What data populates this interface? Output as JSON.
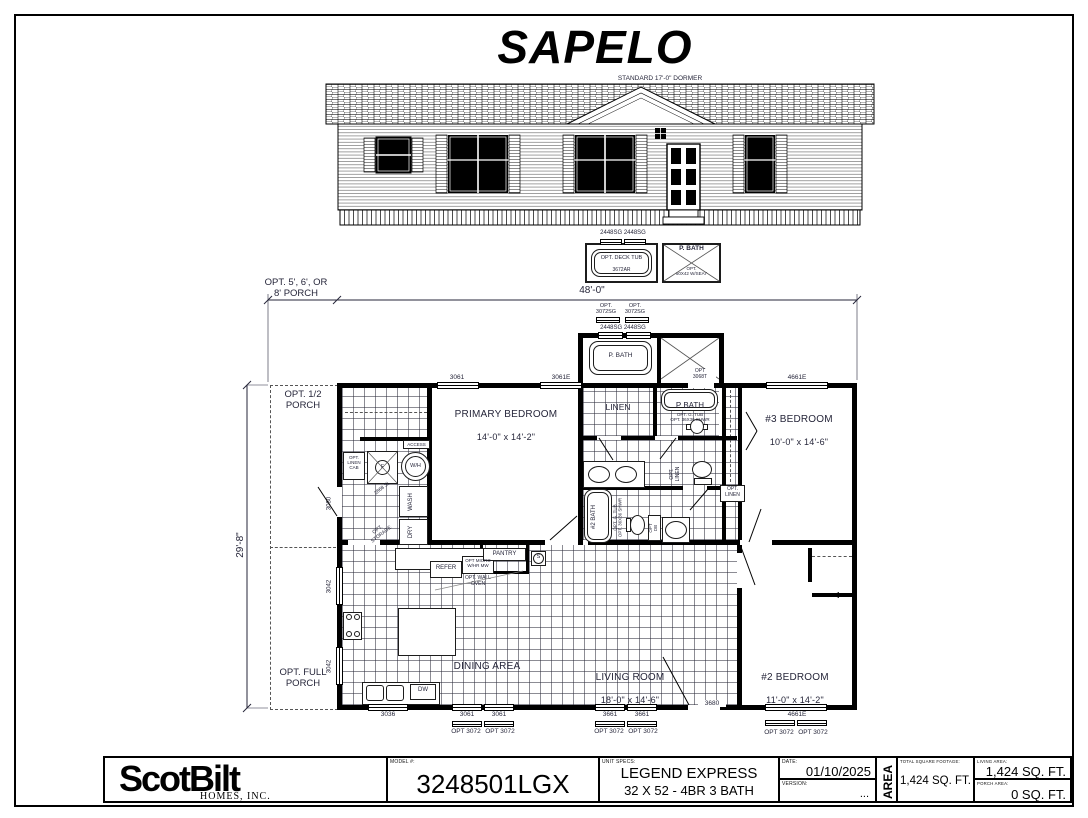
{
  "title": "SAPELO",
  "elevation": {
    "dormer_note": "STANDARD 17'-0\" DORMER"
  },
  "detail": {
    "win_pair": "2448SG 2448SG",
    "deck_tub": "OPT. DECK TUB",
    "deck_tub_size": "3672AR",
    "p_bath": "P. BATH",
    "p_bath_seat": "OPT.\n60X42 W/SEAT"
  },
  "dims": {
    "width": "48'-0\"",
    "porch_opt": "OPT. 5', 6', OR\n8' PORCH",
    "depth": "29'-8\""
  },
  "bump": {
    "opt3072": "OPT.\n3072SG",
    "win_pair": "2448SG 2448SG",
    "p_bath": "P. BATH",
    "door": "OPT\n3068T"
  },
  "plan": {
    "porch_half": "OPT. 1/2\nPORCH",
    "porch_full": "OPT. FULL\nPORCH",
    "primary_name": "PRIMARY BEDROOM",
    "primary_size": "14'-0\" x 14'-2\"",
    "bed3_name": "#3 BEDROOM",
    "bed3_size": "10'-0\" x 14'-6\"",
    "bed2_name": "#2 BEDROOM",
    "bed2_size": "11'-0\" x 14'-2\"",
    "dining": "DINING AREA",
    "living_name": "LIVING ROOM",
    "living_size": "18'-0\" x 14'-6\"",
    "linen": "LINEN",
    "p_bath": "P BATH",
    "p_bath_opt": "OPT. G. TUB\nOPT. 36X36 SHWR",
    "bath2": "#2 BATH",
    "bath2_opt": "OPT. G. TUB\nOPT. 36X36 SHWR",
    "opt_linen_v": "OPT.\nLINEN",
    "opt_linen_box": "OPT.\nLINEN",
    "opt_db": "OPT\nDB",
    "linen_cab": "OPT.\nLINEN\nCAB",
    "wash": "WASH",
    "dry": "DRY",
    "wh": "W/H",
    "f": "F",
    "access": "ACCESS",
    "storage": "OPT.\nSTORAGE",
    "sl_door": "2868 SL",
    "refer": "REFER",
    "micro": "OPT MICRO\nW/HR MW",
    "wall_oven": "OPT. WALL\nOVEN",
    "pantry": "PANTRY",
    "shelf": "S",
    "dw": "DW"
  },
  "windows": {
    "w3061": "3061",
    "w3061e": "3061E",
    "w4661e": "4661E",
    "w3080": "3080",
    "w3042": "3042",
    "w3036": "3036",
    "w3661": "3661",
    "opt3072": "OPT 3072",
    "d3680": "3680"
  },
  "titleblock": {
    "logo": "ScotBilt",
    "logo_sub": "HOMES, INC.",
    "model_label": "MODEL #:",
    "model": "3248501LGX",
    "specs_label": "UNIT SPECS:",
    "specs_line1": "LEGEND EXPRESS",
    "specs_line2": "32 X 52 - 4BR 3 BATH",
    "date_label": "DATE:",
    "date": "01/10/2025",
    "version_label": "VERSION:",
    "version": "...",
    "area": "AREA",
    "total_label": "TOTAL SQUARE FOOTAGE:",
    "total": "1,424 SQ. FT.",
    "living_label": "LIVING AREA:",
    "living": "1,424 SQ. FT.",
    "porch_label": "PORCH AREA:",
    "porch": "0 SQ. FT."
  },
  "colors": {
    "ink": "#26263a",
    "line": "#000000",
    "paper": "#ffffff"
  }
}
